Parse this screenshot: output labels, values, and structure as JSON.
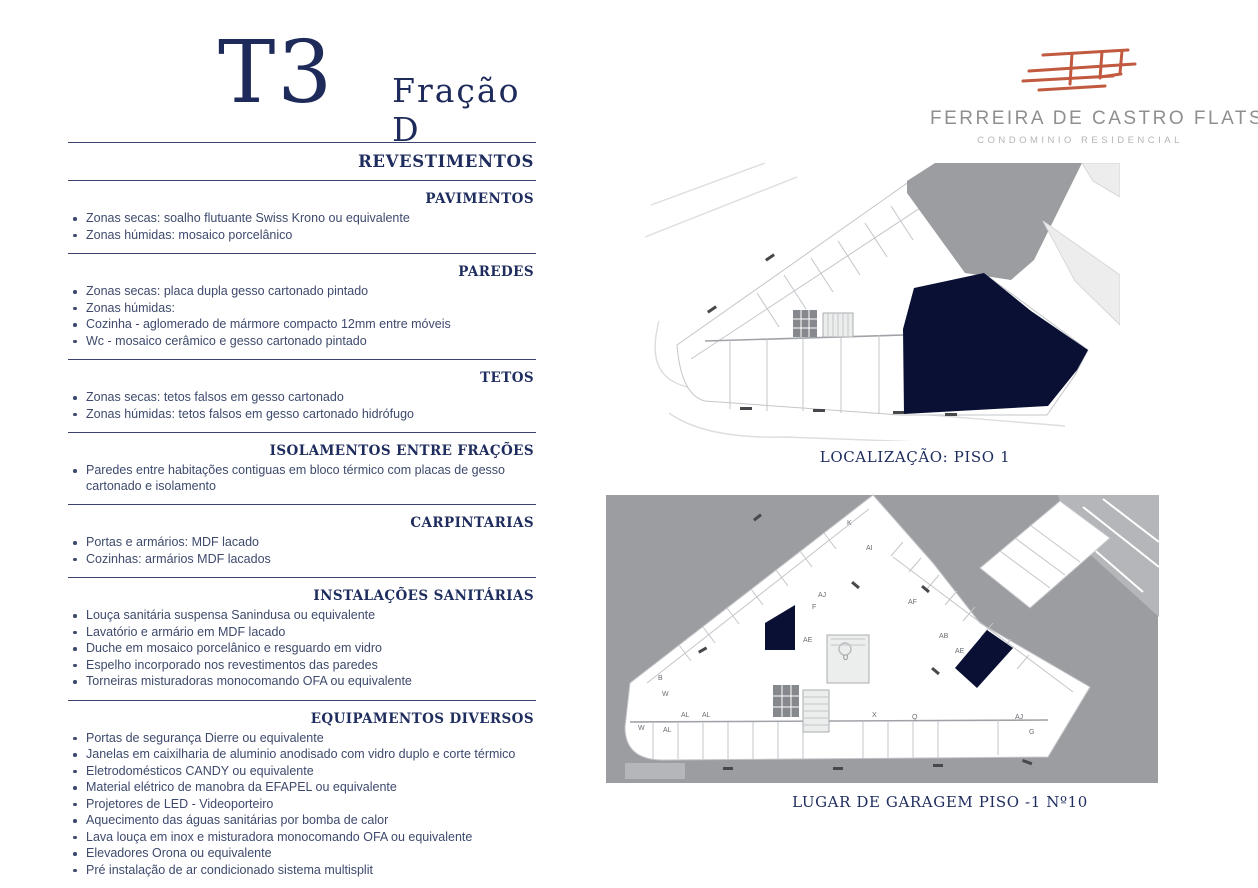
{
  "page": {
    "title_code": "T3",
    "title_fraction": "Fração D"
  },
  "brand": {
    "name": "FERREIRA DE CASTRO FLATS",
    "subtitle": "CONDOMINIO  RESIDENCIAL",
    "logo_icon": "hand-drawn-building-sketch",
    "logo_color": "#c15a3e"
  },
  "colors": {
    "navy_heading": "#1e2c5e",
    "body_text": "#3e4a6d",
    "highlight": "#0a1033",
    "plan_gray": "#9b9da1"
  },
  "spec": {
    "main_heading": "REVESTIMENTOS",
    "sections": [
      {
        "heading": "PAVIMENTOS",
        "items": [
          "Zonas secas: soalho flutuante Swiss Krono ou equivalente",
          "Zonas húmidas: mosaico porcelânico"
        ]
      },
      {
        "heading": "PAREDES",
        "items": [
          "Zonas secas: placa dupla gesso cartonado pintado",
          "Zonas húmidas:",
          "Cozinha - aglomerado de mármore compacto 12mm entre móveis",
          "Wc - mosaico cerâmico e gesso cartonado pintado"
        ]
      },
      {
        "heading": "TETOS",
        "items": [
          "Zonas secas: tetos falsos em gesso cartonado",
          "Zonas húmidas: tetos falsos em gesso cartonado hidrófugo"
        ]
      },
      {
        "heading": "ISOLAMENTOS ENTRE FRAÇÕES",
        "items": [
          "Paredes entre habitações contiguas em bloco térmico com placas de gesso cartonado e isolamento"
        ]
      },
      {
        "heading": "CARPINTARIAS",
        "items": [
          "Portas e armários: MDF lacado",
          "Cozinhas: armários MDF lacados"
        ]
      },
      {
        "heading": "INSTALAÇÕES SANITÁRIAS",
        "items": [
          "Louça sanitária suspensa Sanindusa ou equivalente",
          "Lavatório e armário em MDF lacado",
          "Duche em mosaico porcelânico e resguardo em vidro",
          "Espelho incorporado nos revestimentos das paredes",
          "Torneiras misturadoras monocomando OFA ou equivalente"
        ]
      },
      {
        "heading": "EQUIPAMENTOS DIVERSOS",
        "items": [
          "Portas de segurança Dierre ou equivalente",
          "Janelas em caixilharia de aluminio anodisado com vidro duplo e corte térmico",
          "Eletrodomésticos CANDY ou equivalente",
          "Material elétrico de manobra da EFAPEL ou equivalente",
          "Projetores de LED - Videoporteiro",
          "Aquecimento das águas sanitárias por bomba de calor",
          "Lava louça em inox e misturadora monocomando OFA ou equivalente",
          "Elevadores Orona ou equivalente",
          "Pré instalação de ar condicionado sistema multisplit"
        ]
      }
    ]
  },
  "plans": {
    "location": {
      "caption": "LOCALIZAÇÃO: PISO 1"
    },
    "garage": {
      "caption": "LUGAR DE GARAGEM PISO -1  Nº10",
      "stall_labels": [
        {
          "label": "K",
          "x": 244,
          "y": 38
        },
        {
          "label": "AI",
          "x": 263,
          "y": 63
        },
        {
          "label": "AJ",
          "x": 215,
          "y": 110
        },
        {
          "label": "F",
          "x": 209,
          "y": 122
        },
        {
          "label": "AE",
          "x": 200,
          "y": 155
        },
        {
          "label": "AF",
          "x": 305,
          "y": 117
        },
        {
          "label": "AB",
          "x": 336,
          "y": 151
        },
        {
          "label": "AE",
          "x": 352,
          "y": 166
        },
        {
          "label": "U",
          "x": 240,
          "y": 173
        },
        {
          "label": "B",
          "x": 55,
          "y": 193
        },
        {
          "label": "W",
          "x": 59,
          "y": 209
        },
        {
          "label": "AL",
          "x": 78,
          "y": 230
        },
        {
          "label": "AL",
          "x": 99,
          "y": 230
        },
        {
          "label": "W",
          "x": 35,
          "y": 243
        },
        {
          "label": "AL",
          "x": 60,
          "y": 245
        },
        {
          "label": "X",
          "x": 269,
          "y": 230
        },
        {
          "label": "Q",
          "x": 309,
          "y": 232
        },
        {
          "label": "AJ",
          "x": 412,
          "y": 232
        },
        {
          "label": "G",
          "x": 426,
          "y": 247
        }
      ]
    }
  }
}
